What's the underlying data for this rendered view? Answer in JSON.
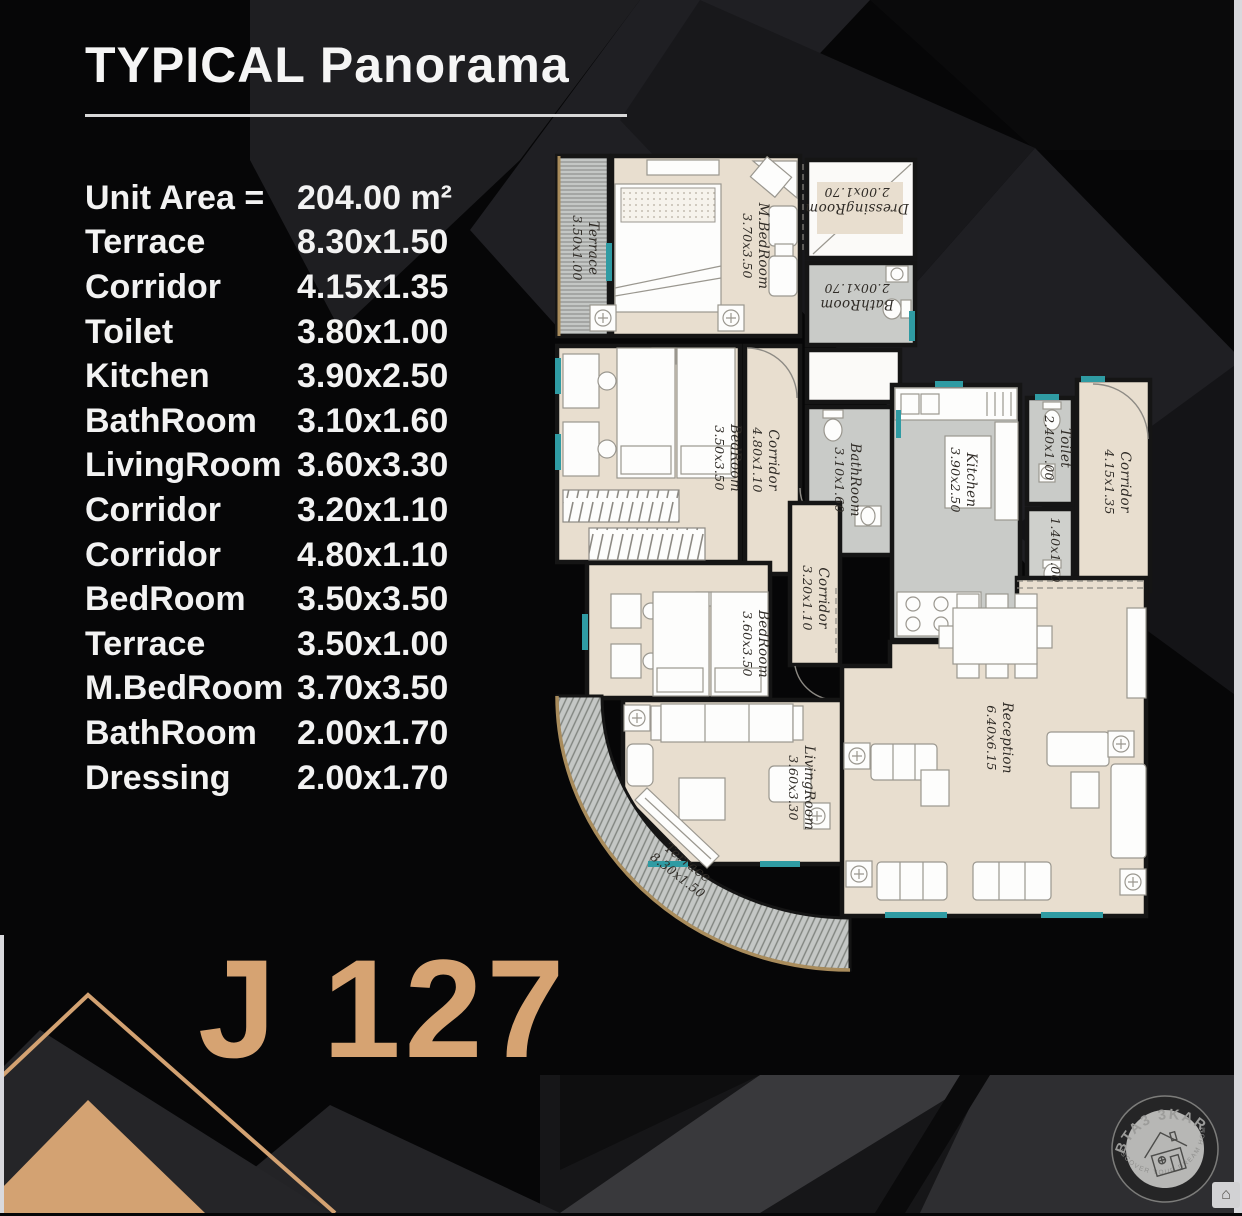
{
  "header": {
    "title": "TYPICAL Panorama"
  },
  "specs": {
    "unit_area_label": "Unit Area =",
    "unit_area_value": "204.00 m²",
    "rows": [
      {
        "name": "Terrace",
        "dims": "8.30x1.50"
      },
      {
        "name": "Corridor",
        "dims": "4.15x1.35"
      },
      {
        "name": "Toilet",
        "dims": "3.80x1.00"
      },
      {
        "name": "Kitchen",
        "dims": "3.90x2.50"
      },
      {
        "name": "BathRoom",
        "dims": "3.10x1.60"
      },
      {
        "name": "LivingRoom",
        "dims": "3.60x3.30"
      },
      {
        "name": "Corridor",
        "dims": "3.20x1.10"
      },
      {
        "name": "Corridor",
        "dims": "4.80x1.10"
      },
      {
        "name": "BedRoom",
        "dims": "3.50x3.50"
      },
      {
        "name": "Terrace",
        "dims": "3.50x1.00"
      },
      {
        "name": "M.BedRoom",
        "dims": "3.70x3.50"
      },
      {
        "name": "BathRoom",
        "dims": "2.00x1.70"
      },
      {
        "name": "Dressing",
        "dims": "2.00x1.70"
      }
    ]
  },
  "unit_code": "J 127",
  "plan": {
    "rooms": [
      {
        "name": "Terrace",
        "dims": "3.50x1.00"
      },
      {
        "name": "M.BedRoom",
        "dims": "3.70x3.50"
      },
      {
        "name": "DressingRoom",
        "dims": "2.00x1.70"
      },
      {
        "name": "BathRoom",
        "dims": "2.00x1.70"
      },
      {
        "name": "BedRoom",
        "dims": "3.50x3.50"
      },
      {
        "name": "Corridor",
        "dims": "4.80x1.10"
      },
      {
        "name": "BathRoom",
        "dims": "3.10x1.60"
      },
      {
        "name": "Kitchen",
        "dims": "3.90x2.50"
      },
      {
        "name": "Toilet",
        "dims": "2.40x1.00"
      },
      {
        "name": "",
        "dims": "1.40x1.00"
      },
      {
        "name": "Corridor",
        "dims": "4.15x1.35"
      },
      {
        "name": "BedRoom",
        "dims": "3.60x3.50"
      },
      {
        "name": "Corridor",
        "dims": "3.20x1.10"
      },
      {
        "name": "LivingRoom",
        "dims": "3.60x3.30"
      },
      {
        "name": "Reception",
        "dims": "6.40x6.15"
      },
      {
        "name": "Terrace",
        "dims": "8.30x1.50"
      }
    ]
  },
  "watermark": {
    "brand": "BTA3 3KAR",
    "tagline": "DISCOVER YOUR DREAM HOME",
    "chip_icon": "⌂"
  },
  "colors": {
    "accent_gold": "#d6a372",
    "room_beige": "#e8decf",
    "wet_room_gray": "#c9cbc8",
    "window_teal": "#2f9ba3"
  }
}
